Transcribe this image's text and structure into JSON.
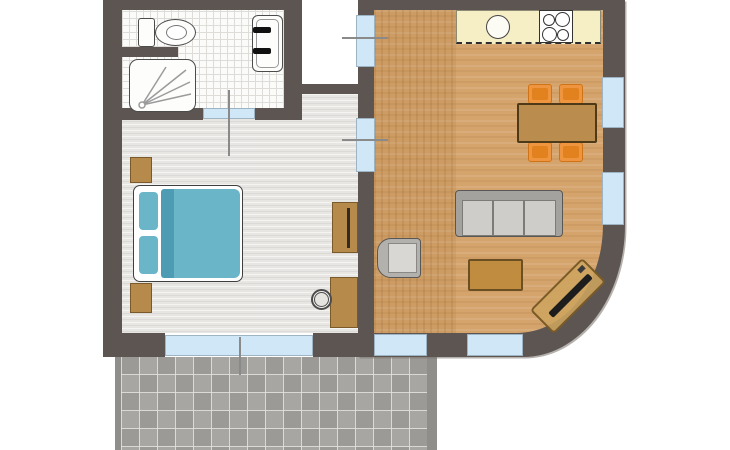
{
  "meta": {
    "kind": "apartment-floor-plan",
    "image_width": 730,
    "image_height": 450,
    "visible_text": "none"
  },
  "colors": {
    "wall": "#5d5551",
    "window_glass": "#cfe7f7",
    "living_floor": "#d4a46c",
    "bedroom_floor": "#e7e6e3",
    "bathroom_floor": "#fbfbfa",
    "terrace_tile": "#a7a6a3",
    "terrace_tile_alt": "#9b9a97",
    "kitchen_counter": "#f6efc6",
    "bed_teal": "#6bb5c9",
    "bed_teal_dark": "#4d9cb4",
    "furniture_brown": "#b58a4a",
    "chair_orange": "#f0953f",
    "sofa_gray": "#a4a29f",
    "cushion_gray": "#cfcdca",
    "door_swing": "#8a8a8a"
  },
  "rooms": [
    {
      "name": "bathroom",
      "position": "top-left",
      "floor": "white-grid-tile",
      "fixtures": [
        "toilet",
        "shower",
        "bathtub"
      ]
    },
    {
      "name": "bedroom",
      "position": "left",
      "floor": "light-gray-planks",
      "furniture": [
        "double-bed",
        "pillows-2",
        "nightstands-2",
        "wardrobe",
        "desk",
        "desk-chair"
      ]
    },
    {
      "name": "living-room-kitchen",
      "position": "right",
      "floor": "wood",
      "corner": "rounded-bottom-right",
      "furniture": [
        "kitchen-counter",
        "round-sink",
        "stove-4-burner",
        "dining-table",
        "dining-chairs-4",
        "sofa-3-seat",
        "coffee-table",
        "armchair",
        "tv-bench-diagonal"
      ]
    },
    {
      "name": "entrance-recess",
      "position": "top-center",
      "floor": "none"
    },
    {
      "name": "terrace",
      "position": "bottom",
      "floor": "gray-square-tiles"
    }
  ],
  "openings": {
    "doors": [
      "entry-door",
      "bedroom-living-door",
      "bathroom-door"
    ],
    "windows": [
      "bedroom-south-large",
      "living-south-1",
      "living-south-2",
      "living-east-1",
      "living-east-2"
    ]
  },
  "counts": {
    "stove_burners": 4,
    "sofa_seats": 3,
    "dining_chairs": 4,
    "bed_pillows": 2,
    "nightstands": 2
  }
}
